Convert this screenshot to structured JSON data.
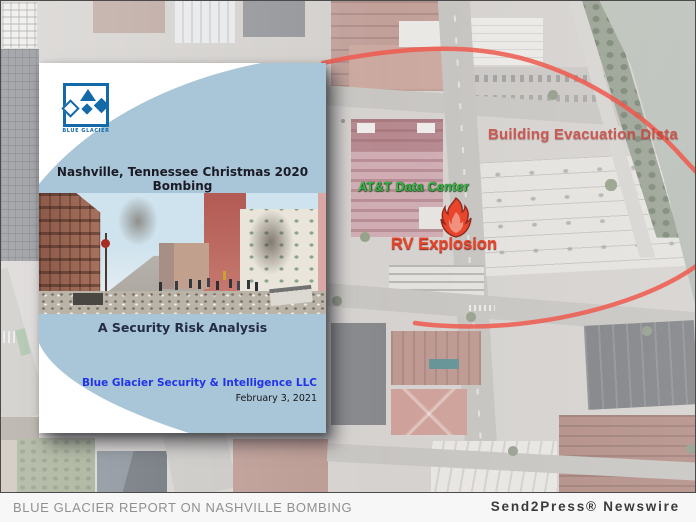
{
  "colors": {
    "cover_blue": "#a9c6d8",
    "accent_blue": "#2133e8",
    "logo_blue": "#1469a8",
    "green": "#3eb54b",
    "red": "#e8452c",
    "evac_red": "#c8453e",
    "circle_red": "#ee594d"
  },
  "report_cover": {
    "logo_text": "BLUE GLACIER",
    "title": "Nashville, Tennessee Christmas 2020 Bombing",
    "subtitle": "A Security Risk Analysis",
    "company": "Blue Glacier Security & Intelligence LLC",
    "date": "February 3, 2021"
  },
  "map": {
    "labels": {
      "att": "AT&T Data Center",
      "rv": "RV Explosion",
      "evac": "Building Evacuation Dista"
    }
  },
  "footer": {
    "caption": "BLUE GLACIER REPORT ON NASHVILLE BOMBING",
    "credit": "Send2Press® Newswire"
  }
}
